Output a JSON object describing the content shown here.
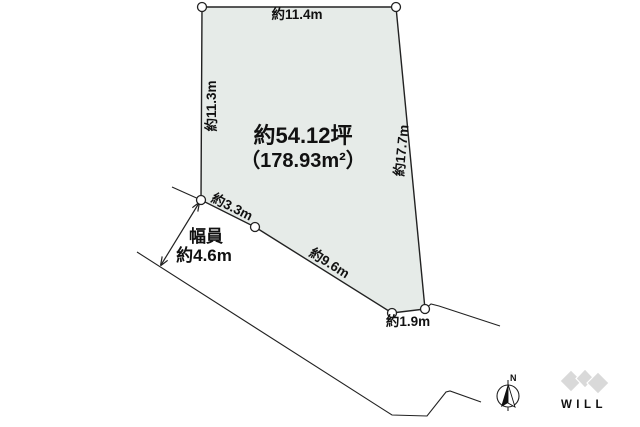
{
  "diagram": {
    "plot": {
      "area_tsubo": "約54.12坪",
      "area_sqm": "（178.93m²）",
      "fill_color": "#e6ebe8"
    },
    "dimensions": {
      "top": "約11.4m",
      "left": "約11.3m",
      "right": "約17.7m",
      "lower_left": "約3.3m",
      "lower_right": "約9.6m",
      "bottom": "約1.9m"
    },
    "road": {
      "width_title": "幅員",
      "width_value": "約4.6m"
    },
    "compass": {
      "north": "N"
    },
    "logo": {
      "text": "WILL",
      "color": "#d9d9d9",
      "text_color": "#cccccc"
    },
    "line_color": "#222222"
  }
}
